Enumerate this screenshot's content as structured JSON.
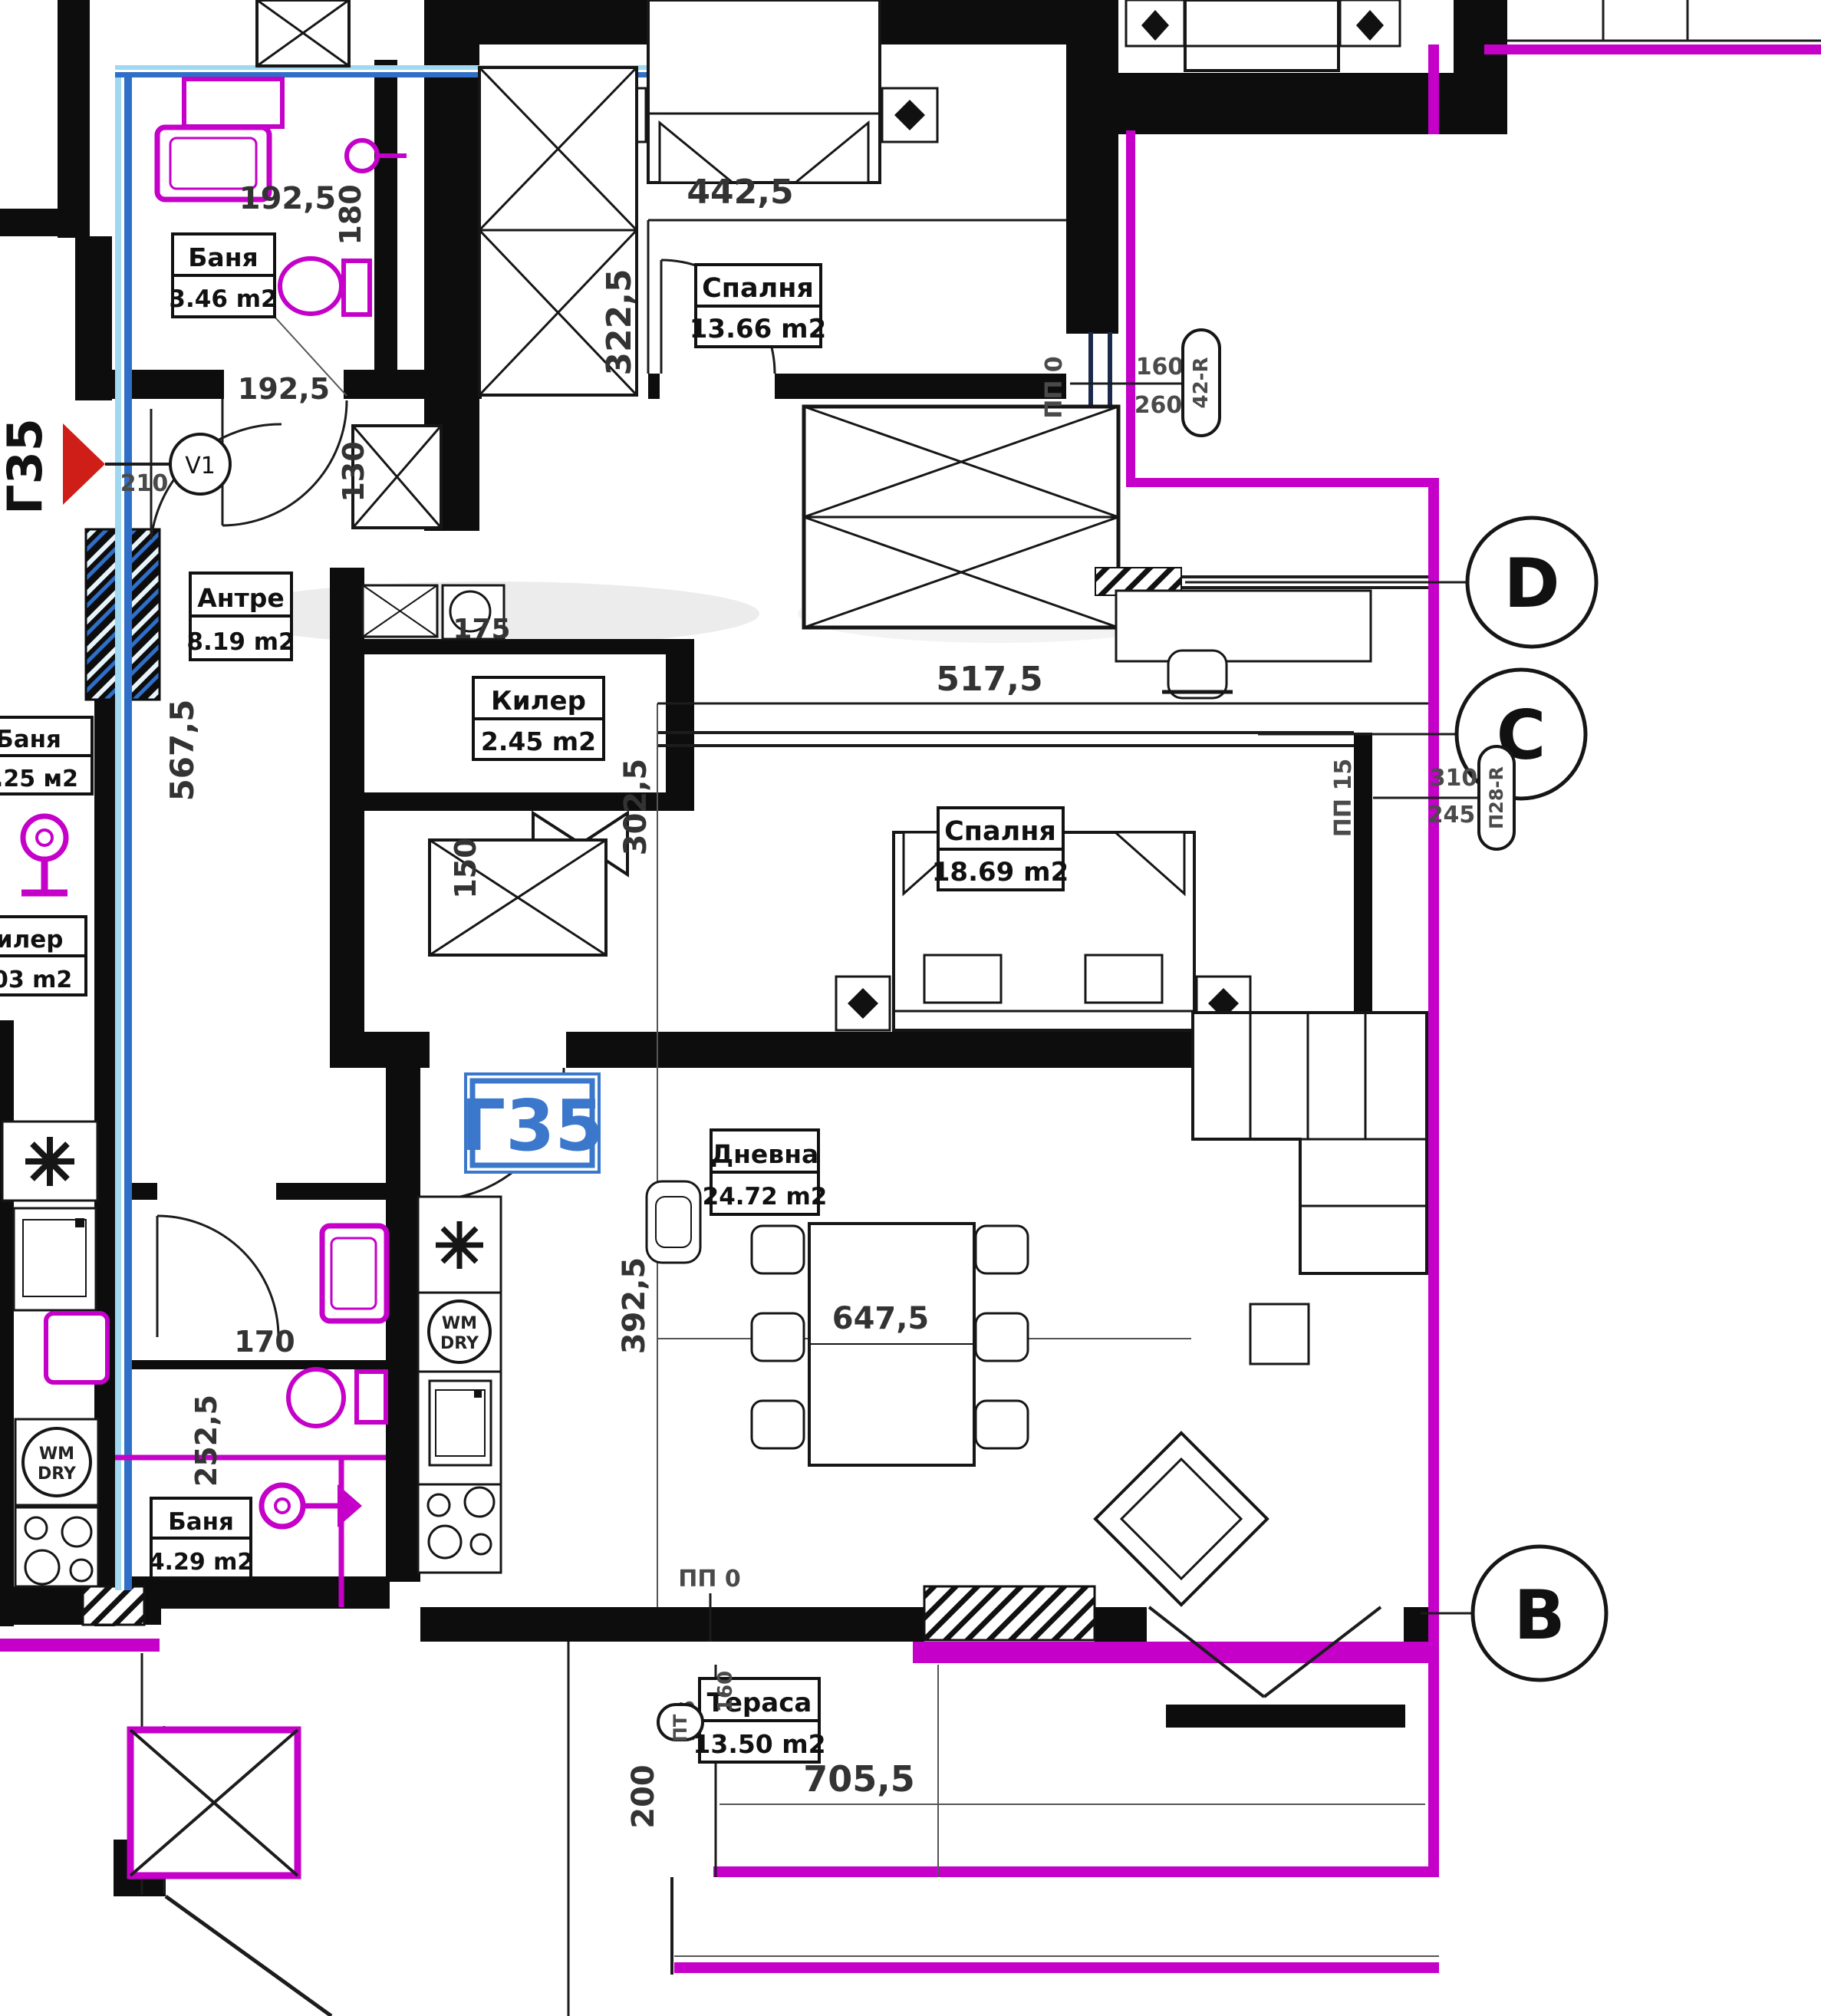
{
  "colors": {
    "wall": "#0d0d0d",
    "magenta": "#c400c9",
    "blue": "#2f6fc8",
    "lightblue": "#9fd8f0",
    "red": "#cf1d17",
    "label_blue": "#3b78cc"
  },
  "unit": {
    "code": "Г35"
  },
  "markers": {
    "entry_tag": "Г35",
    "vent": "V1",
    "grid_d": "D",
    "grid_c": "C",
    "grid_b": "B",
    "pp0_top": {
      "label": "ПП 0",
      "dim_a": "160",
      "dim_b": "260",
      "tag": "42-R"
    },
    "pp15": {
      "label": "ПП 15",
      "dim_a": "310",
      "dim_b": "245",
      "tag": "П28-R"
    },
    "pp0_bottom": {
      "label": "ПП 0"
    },
    "pt": {
      "tag": "ПТ",
      "dim_a": "285",
      "dim_b": "160"
    }
  },
  "rooms": {
    "bath1": {
      "name": "Баня",
      "area": "3.46 m2"
    },
    "bedroom1": {
      "name": "Спалня",
      "area": "13.66 m2"
    },
    "hall": {
      "name": "Антре",
      "area": "8.19 m2"
    },
    "closet": {
      "name": "Килер",
      "area": "2.45 m2"
    },
    "bedroom2": {
      "name": "Спалня",
      "area": "18.69 m2"
    },
    "living": {
      "name": "Дневна",
      "area": "24.72 m2"
    },
    "bath2": {
      "name": "Баня",
      "area": "4.29 m2"
    },
    "terrace": {
      "name": "Тераса",
      "area": "13.50 m2"
    }
  },
  "neighbor_rooms": {
    "bath": {
      "name": "Баня",
      "area": "3.25 м2"
    },
    "closet": {
      "name": "Килер",
      "area": "1.03 m2"
    }
  },
  "dimensions": {
    "bath1_w": "192,5",
    "bath1_h": "180",
    "bed1_w": "442,5",
    "bed1_h": "322,5",
    "nook_w": "192,5",
    "nook_h": "130",
    "entry_w": "210",
    "hall_len": "567,5",
    "closet_w": "175",
    "bed2_w": "517,5",
    "bed2_len": "302,5",
    "offset_150": "150",
    "bath2_w": "170",
    "bath2_len": "252,5",
    "living_len": "392,5",
    "living_w": "647,5",
    "terrace_w": "705,5",
    "terrace_len": "200"
  },
  "appliances": {
    "wm": "WM",
    "dry": "DRY"
  }
}
